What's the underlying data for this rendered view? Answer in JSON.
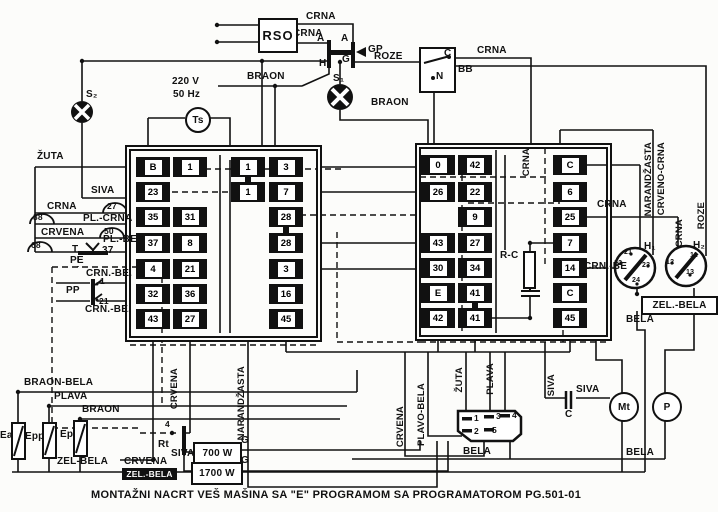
{
  "title": "MONTAŽNI NACRT VEŠ MAŠINA SA \"E\" PROGRAMOM SA PROGRAMATOROM PG.501-01",
  "colors": {
    "ink": "#111111",
    "paper": "#fcfcfa"
  },
  "labels": [
    {
      "n": "supply-voltage",
      "t": "220 V",
      "x": 172,
      "y": 76
    },
    {
      "n": "supply-frequency",
      "t": "50 Hz",
      "x": 173,
      "y": 89
    },
    {
      "n": "wire-crna-top",
      "t": "CRNA",
      "x": 306,
      "y": 11
    },
    {
      "n": "wire-crna-rso",
      "t": "CRNA",
      "x": 293,
      "y": 28
    },
    {
      "n": "gp-terminal-a-left",
      "t": "A",
      "x": 317,
      "y": 33
    },
    {
      "n": "gp-terminal-a-right",
      "t": "A",
      "x": 341,
      "y": 33
    },
    {
      "n": "gp-label",
      "t": "GP",
      "x": 368,
      "y": 44
    },
    {
      "n": "gp-terminal-h",
      "t": "H",
      "x": 319,
      "y": 58
    },
    {
      "n": "gp-terminal-g",
      "t": "G",
      "x": 342,
      "y": 54
    },
    {
      "n": "wire-roze-top",
      "t": "ROZE",
      "x": 374,
      "y": 51
    },
    {
      "n": "lamp-s1-label",
      "t": "S₁",
      "x": 333,
      "y": 73
    },
    {
      "n": "wire-braon-top",
      "t": "BRAON",
      "x": 247,
      "y": 71
    },
    {
      "n": "wire-braon-mid",
      "t": "BRAON",
      "x": 371,
      "y": 97
    },
    {
      "n": "bb-terminal-c",
      "t": "C",
      "x": 444,
      "y": 48
    },
    {
      "n": "bb-terminal-n",
      "t": "N",
      "x": 436,
      "y": 71
    },
    {
      "n": "bb-label",
      "t": "BB",
      "x": 458,
      "y": 64
    },
    {
      "n": "wire-crna-bb",
      "t": "CRNA",
      "x": 477,
      "y": 45
    },
    {
      "n": "lamp-s2-label",
      "t": "S₂",
      "x": 86,
      "y": 89
    },
    {
      "n": "wire-zuta-left",
      "t": "ŽUTA",
      "x": 37,
      "y": 151
    },
    {
      "n": "wire-siva-left",
      "t": "SIVA",
      "x": 91,
      "y": 185
    },
    {
      "n": "thermo-27",
      "t": "27",
      "x": 107,
      "y": 201,
      "c": "b"
    },
    {
      "n": "wire-crna-left",
      "t": "CRNA",
      "x": 47,
      "y": 201
    },
    {
      "n": "thermo-38",
      "t": "38",
      "x": 33,
      "y": 212,
      "c": "b"
    },
    {
      "n": "wire-pl-crna",
      "t": "PL.-CRNA",
      "x": 83,
      "y": 213
    },
    {
      "n": "thermo-50",
      "t": "50",
      "x": 104,
      "y": 226,
      "c": "b"
    },
    {
      "n": "wire-crvena-left",
      "t": "CRVENA",
      "x": 41,
      "y": 227
    },
    {
      "n": "wire-pl-be",
      "t": "PL.-BE.",
      "x": 103,
      "y": 234
    },
    {
      "n": "thermo-68",
      "t": "68",
      "x": 31,
      "y": 240,
      "c": "b"
    },
    {
      "n": "thermo-t-label",
      "t": "T",
      "x": 72,
      "y": 244
    },
    {
      "n": "label-37",
      "t": "37",
      "x": 102,
      "y": 245
    },
    {
      "n": "terminal-pe",
      "t": "PE",
      "x": 70,
      "y": 255
    },
    {
      "n": "wire-crn-be-1",
      "t": "CRN.-BE.",
      "x": 86,
      "y": 268
    },
    {
      "n": "pp-label",
      "t": "PP",
      "x": 66,
      "y": 285
    },
    {
      "n": "pp-pin-1",
      "t": "1",
      "x": 100,
      "y": 276,
      "c": "s"
    },
    {
      "n": "pp-pin-21",
      "t": "21",
      "x": 99,
      "y": 296,
      "c": "s"
    },
    {
      "n": "wire-crn-be-2",
      "t": "CRN.-BE.",
      "x": 85,
      "y": 304
    },
    {
      "n": "rc-label",
      "t": "R-C",
      "x": 500,
      "y": 250
    },
    {
      "n": "wire-crna-right",
      "t": "CRNA",
      "x": 597,
      "y": 199
    },
    {
      "n": "wire-crn-be-right",
      "t": "CRN.-BE",
      "x": 584,
      "y": 261
    },
    {
      "n": "h1-label",
      "t": "H₁",
      "x": 644,
      "y": 241
    },
    {
      "n": "h2-label",
      "t": "H₂",
      "x": 693,
      "y": 240
    },
    {
      "n": "wire-bela-right",
      "t": "BELA",
      "x": 626,
      "y": 314
    },
    {
      "n": "wire-braon-bela",
      "t": "BRAON-BELA",
      "x": 24,
      "y": 377
    },
    {
      "n": "wire-plava-left",
      "t": "PLAVA",
      "x": 54,
      "y": 391
    },
    {
      "n": "wire-braon-bottom",
      "t": "BRAON",
      "x": 82,
      "y": 404
    },
    {
      "n": "heater-ea-label",
      "t": "Ea",
      "x": 0,
      "y": 430
    },
    {
      "n": "heater-epp-label",
      "t": "Epp",
      "x": 25,
      "y": 431
    },
    {
      "n": "heater-ep-label",
      "t": "Ep",
      "x": 60,
      "y": 429
    },
    {
      "n": "wire-zel-bela-left",
      "t": "ZEL-BELA",
      "x": 57,
      "y": 456
    },
    {
      "n": "wire-crvena-bottom",
      "t": "CRVENA",
      "x": 124,
      "y": 456
    },
    {
      "n": "rt-pin-4",
      "t": "4",
      "x": 165,
      "y": 419,
      "c": "s"
    },
    {
      "n": "rt-label",
      "t": "Rt",
      "x": 158,
      "y": 439
    },
    {
      "n": "wire-siva-bottom",
      "t": "SIVA",
      "x": 171,
      "y": 448
    },
    {
      "n": "g-700",
      "t": "G",
      "x": 241,
      "y": 435
    },
    {
      "n": "g-1700",
      "t": "G",
      "x": 241,
      "y": 455
    },
    {
      "n": "wire-bela-center",
      "t": "BELA",
      "x": 463,
      "y": 446
    },
    {
      "n": "wire-bela-bottom-right",
      "t": "BELA",
      "x": 626,
      "y": 447
    },
    {
      "n": "wire-siva-cap",
      "t": "SIVA",
      "x": 576,
      "y": 384
    },
    {
      "n": "cap-c-label",
      "t": "C",
      "x": 565,
      "y": 409
    },
    {
      "n": "motor-pin-1",
      "t": "1",
      "x": 474,
      "y": 413,
      "c": "s"
    },
    {
      "n": "motor-pin-3",
      "t": "3",
      "x": 496,
      "y": 411,
      "c": "s"
    },
    {
      "n": "motor-pin-4",
      "t": "4",
      "x": 512,
      "y": 410,
      "c": "s"
    },
    {
      "n": "motor-pin-2",
      "t": "2",
      "x": 474,
      "y": 426,
      "c": "s"
    },
    {
      "n": "motor-pin-5",
      "t": "5",
      "x": 492,
      "y": 425,
      "c": "s"
    },
    {
      "n": "h1-pin-21",
      "t": "21",
      "x": 624,
      "y": 249,
      "c": "xs"
    },
    {
      "n": "h1-pin-22",
      "t": "22",
      "x": 614,
      "y": 260,
      "c": "xs"
    },
    {
      "n": "h1-pin-23",
      "t": "23",
      "x": 642,
      "y": 262,
      "c": "xs"
    },
    {
      "n": "h1-pin-24",
      "t": "24",
      "x": 632,
      "y": 277,
      "c": "xs"
    },
    {
      "n": "h2-pin-12",
      "t": "12",
      "x": 666,
      "y": 259,
      "c": "xs"
    },
    {
      "n": "h2-pin-11",
      "t": "11",
      "x": 690,
      "y": 252,
      "c": "xs"
    },
    {
      "n": "h2-pin-13",
      "t": "13",
      "x": 686,
      "y": 269,
      "c": "xs"
    },
    {
      "n": "wire-crna-programmer",
      "t": "CRNA",
      "x": 521,
      "y": 148,
      "c": "v"
    },
    {
      "n": "wire-narandzasta-right",
      "t": "NARANDŽASTA",
      "x": 643,
      "y": 142,
      "c": "v"
    },
    {
      "n": "wire-crveno-crna",
      "t": "CRVENO-CRNA",
      "x": 656,
      "y": 142,
      "c": "v"
    },
    {
      "n": "wire-roze-right",
      "t": "ROZE",
      "x": 696,
      "y": 202,
      "c": "v"
    },
    {
      "n": "wire-crna-h2",
      "t": "CRNA",
      "x": 674,
      "y": 219,
      "c": "v"
    },
    {
      "n": "wire-crvena-mid",
      "t": "CRVENA",
      "x": 169,
      "y": 368,
      "c": "v"
    },
    {
      "n": "wire-narandzasta-mid",
      "t": "NARANDŽASTA",
      "x": 236,
      "y": 366,
      "c": "v"
    },
    {
      "n": "wire-crvena-motor",
      "t": "CRVENA",
      "x": 395,
      "y": 406,
      "c": "v"
    },
    {
      "n": "wire-plavo-bela",
      "t": "PLAVO-BELA",
      "x": 416,
      "y": 383,
      "c": "v"
    },
    {
      "n": "wire-zuta-motor",
      "t": "ŽUTA",
      "x": 454,
      "y": 367,
      "c": "v"
    },
    {
      "n": "wire-plava-motor",
      "t": "PLAVA",
      "x": 485,
      "y": 363,
      "c": "v"
    },
    {
      "n": "wire-siva-motor",
      "t": "SIVA",
      "x": 546,
      "y": 374,
      "c": "v"
    },
    {
      "n": "rso-label",
      "t": "RSO",
      "x": 258,
      "y": 18,
      "w": 36,
      "h": 31,
      "c": "box big"
    },
    {
      "n": "heater-700w",
      "t": "700 W",
      "x": 193,
      "y": 442,
      "w": 45,
      "h": 19,
      "c": "box"
    },
    {
      "n": "heater-1700w",
      "t": "1700 W",
      "x": 191,
      "y": 462,
      "w": 48,
      "h": 19,
      "c": "box"
    },
    {
      "n": "wire-zel-bela-right",
      "t": "ZEL.-BELA",
      "x": 641,
      "y": 296,
      "w": 73,
      "h": 15,
      "c": "box"
    },
    {
      "n": "wire-zel-bela-inverted",
      "t": "ZEL.-BELA",
      "x": 122,
      "y": 468,
      "w": 55,
      "h": 12,
      "c": "inv"
    },
    {
      "n": "programmer-timer-ts",
      "t": "Ts",
      "x": 185,
      "y": 107,
      "w": 22,
      "h": 22,
      "c": "circ"
    },
    {
      "n": "motor-mt",
      "t": "Mt",
      "x": 609,
      "y": 392,
      "w": 26,
      "h": 26,
      "c": "circ"
    },
    {
      "n": "pump-p",
      "t": "P",
      "x": 652,
      "y": 392,
      "w": 26,
      "h": 26,
      "c": "circ"
    }
  ],
  "blocks": [
    {
      "name": "left-terminal-block",
      "x": 125,
      "y": 145,
      "w": 193,
      "h": 193,
      "cols": [
        153,
        190,
        248,
        286
      ],
      "rows": [
        167,
        192,
        217,
        243,
        269,
        294,
        319
      ],
      "cells": [
        {
          "c": 0,
          "r": 0,
          "v": "B"
        },
        {
          "c": 1,
          "r": 0,
          "v": "1"
        },
        {
          "c": 2,
          "r": 0,
          "v": "1"
        },
        {
          "c": 3,
          "r": 0,
          "v": "3"
        },
        {
          "c": 0,
          "r": 1,
          "v": "23"
        },
        {
          "c": 2,
          "r": 1,
          "v": "1"
        },
        {
          "c": 3,
          "r": 1,
          "v": "7"
        },
        {
          "c": 0,
          "r": 2,
          "v": "35"
        },
        {
          "c": 1,
          "r": 2,
          "v": "31"
        },
        {
          "c": 3,
          "r": 2,
          "v": "28"
        },
        {
          "c": 0,
          "r": 3,
          "v": "37"
        },
        {
          "c": 1,
          "r": 3,
          "v": "8"
        },
        {
          "c": 3,
          "r": 3,
          "v": "28"
        },
        {
          "c": 0,
          "r": 4,
          "v": "4"
        },
        {
          "c": 1,
          "r": 4,
          "v": "21"
        },
        {
          "c": 3,
          "r": 4,
          "v": "3"
        },
        {
          "c": 0,
          "r": 5,
          "v": "32"
        },
        {
          "c": 1,
          "r": 5,
          "v": "36"
        },
        {
          "c": 3,
          "r": 5,
          "v": "16"
        },
        {
          "c": 0,
          "r": 6,
          "v": "43"
        },
        {
          "c": 1,
          "r": 6,
          "v": "27"
        },
        {
          "c": 3,
          "r": 6,
          "v": "45"
        }
      ],
      "links": [
        {
          "c": 2,
          "from": 0,
          "to": 1
        },
        {
          "c": 3,
          "from": 2,
          "to": 3
        }
      ]
    },
    {
      "name": "right-terminal-block",
      "x": 415,
      "y": 143,
      "w": 193,
      "h": 194,
      "cols": [
        438,
        475,
        570
      ],
      "rows": [
        165,
        192,
        217,
        243,
        268,
        293,
        318
      ],
      "cells": [
        {
          "c": 0,
          "r": 0,
          "v": "0"
        },
        {
          "c": 1,
          "r": 0,
          "v": "42"
        },
        {
          "c": 2,
          "r": 0,
          "v": "C"
        },
        {
          "c": 0,
          "r": 1,
          "v": "26"
        },
        {
          "c": 1,
          "r": 1,
          "v": "22"
        },
        {
          "c": 2,
          "r": 1,
          "v": "6"
        },
        {
          "c": 1,
          "r": 2,
          "v": "9"
        },
        {
          "c": 2,
          "r": 2,
          "v": "25"
        },
        {
          "c": 0,
          "r": 3,
          "v": "43"
        },
        {
          "c": 1,
          "r": 3,
          "v": "27"
        },
        {
          "c": 2,
          "r": 3,
          "v": "7"
        },
        {
          "c": 0,
          "r": 4,
          "v": "30"
        },
        {
          "c": 1,
          "r": 4,
          "v": "34"
        },
        {
          "c": 2,
          "r": 4,
          "v": "14"
        },
        {
          "c": 0,
          "r": 5,
          "v": "E"
        },
        {
          "c": 1,
          "r": 5,
          "v": "41"
        },
        {
          "c": 2,
          "r": 5,
          "v": "C"
        },
        {
          "c": 0,
          "r": 6,
          "v": "42"
        },
        {
          "c": 1,
          "r": 6,
          "v": "41"
        },
        {
          "c": 2,
          "r": 6,
          "v": "45"
        }
      ],
      "links": [
        {
          "c": 1,
          "from": 5,
          "to": 6
        }
      ]
    }
  ]
}
